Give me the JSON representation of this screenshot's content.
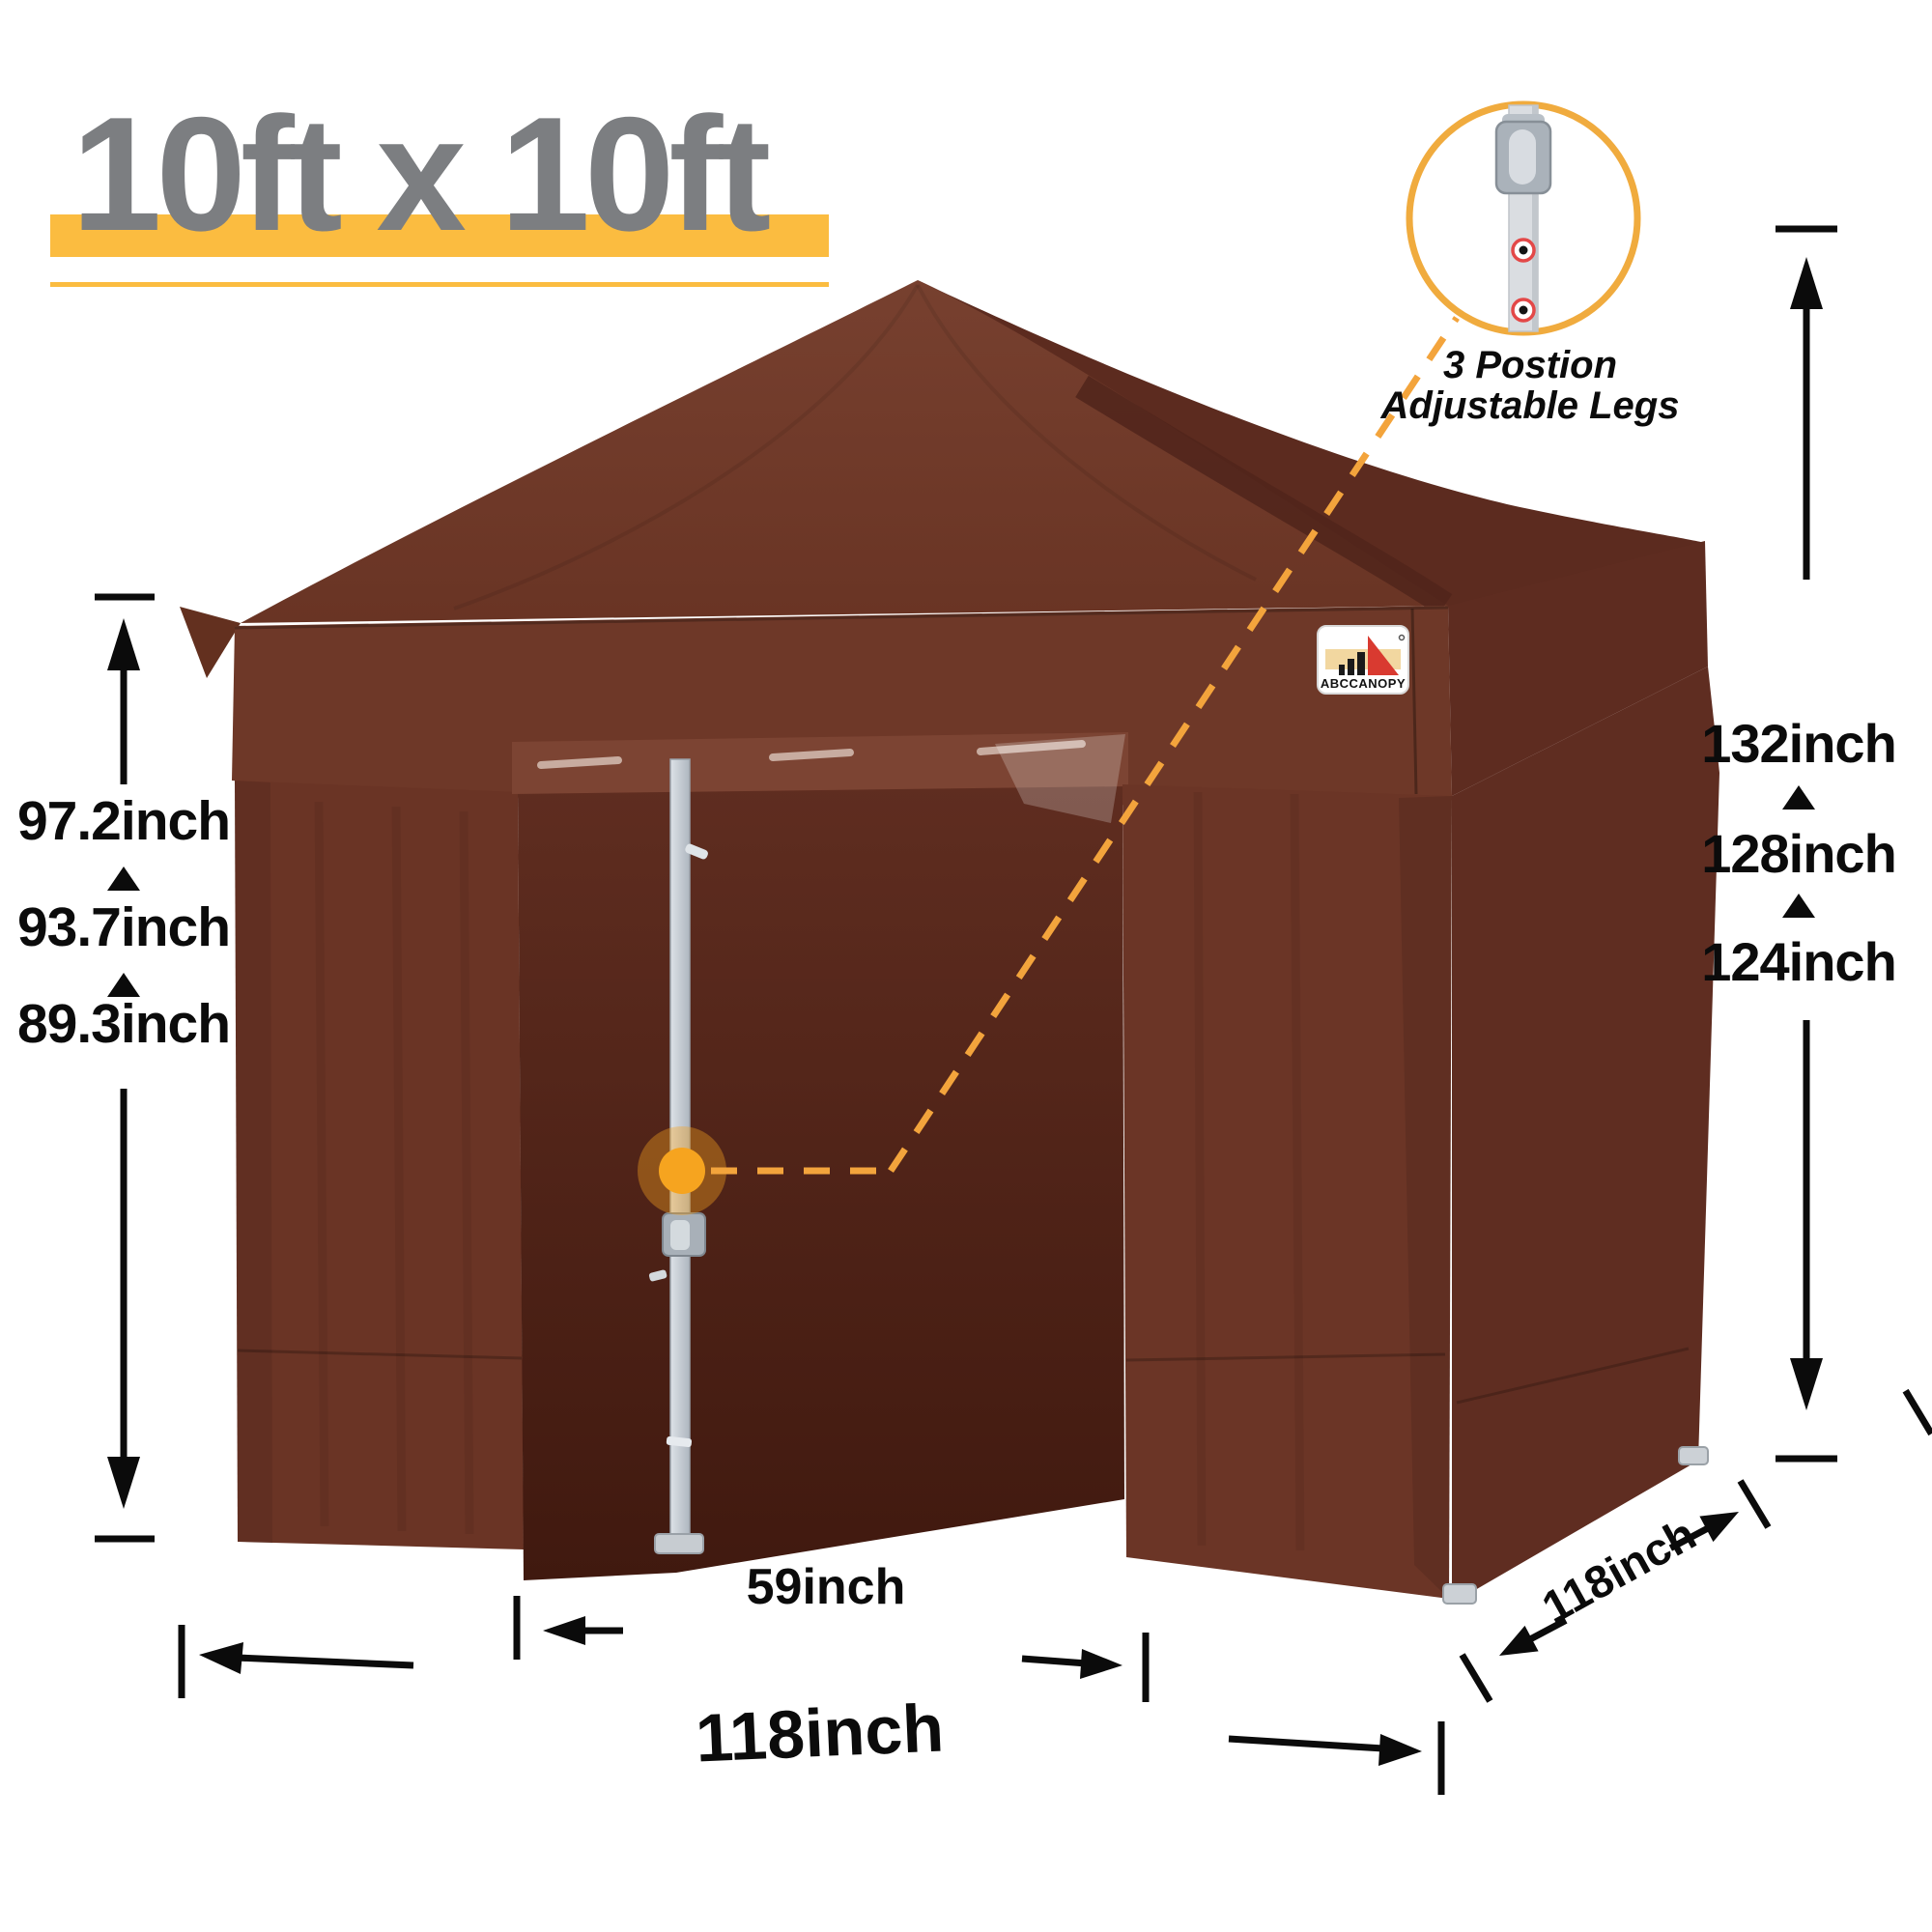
{
  "title": {
    "text": "10ft x 10ft"
  },
  "callout": {
    "line1": "3 Postion",
    "line2": "Adjustable Legs"
  },
  "logo": {
    "brand": "ABCCANOPY"
  },
  "measurements": {
    "left_heights": [
      "97.2inch",
      "93.7inch",
      "89.3inch"
    ],
    "right_heights": [
      "132inch",
      "128inch",
      "124inch"
    ],
    "door_width": "59inch",
    "front_width": "118inch",
    "side_depth": "118inch"
  },
  "colors": {
    "canopy_brown": "#6b3526",
    "canopy_dark_brown": "#5c2b1f",
    "door_interior_brown": "#451d11",
    "accent_yellow": "#fbbc40",
    "dash_orange": "#f3a43c",
    "dot_orange": "#f6a41f",
    "title_gray": "#7c7e81",
    "dimension_black": "#0b0b0b",
    "frame_gray": "#c7cdd4",
    "hole_ring_red": "#e34848"
  }
}
